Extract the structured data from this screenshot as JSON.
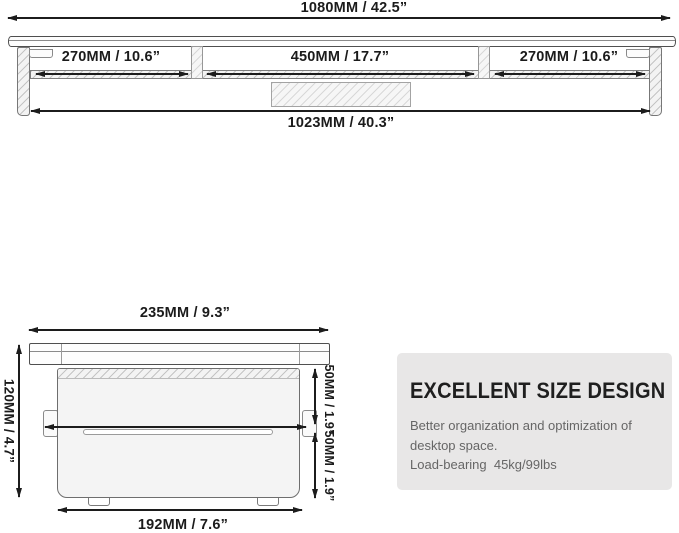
{
  "front_view": {
    "overall_width": "1080MM / 42.5”",
    "left_shelf_width": "270MM / 10.6”",
    "middle_shelf_width": "450MM / 17.7”",
    "right_shelf_width": "270MM / 10.6”",
    "base_width": "1023MM / 40.3”"
  },
  "side_view": {
    "top_depth": "235MM / 9.3”",
    "total_height": "120MM / 4.7”",
    "inner_depth": "216MM / 8.5”",
    "upper_opening_height": "50MM / 1.9”",
    "lower_opening_height": "50MM / 1.9”",
    "base_depth": "192MM / 7.6”"
  },
  "info_panel": {
    "heading": "EXCELLENT SIZE DESIGN",
    "lines": [
      "Better organization and optimization of",
      "desktop space.",
      "Load-bearing  45kg/99lbs"
    ]
  },
  "colors": {
    "background": "#ffffff",
    "dimension_line": "#1c1c1c",
    "drawing_outline": "#6e6e6e",
    "panel_background": "#e8e7e7",
    "heading_text": "#1f1f1f",
    "body_text": "#666666"
  }
}
